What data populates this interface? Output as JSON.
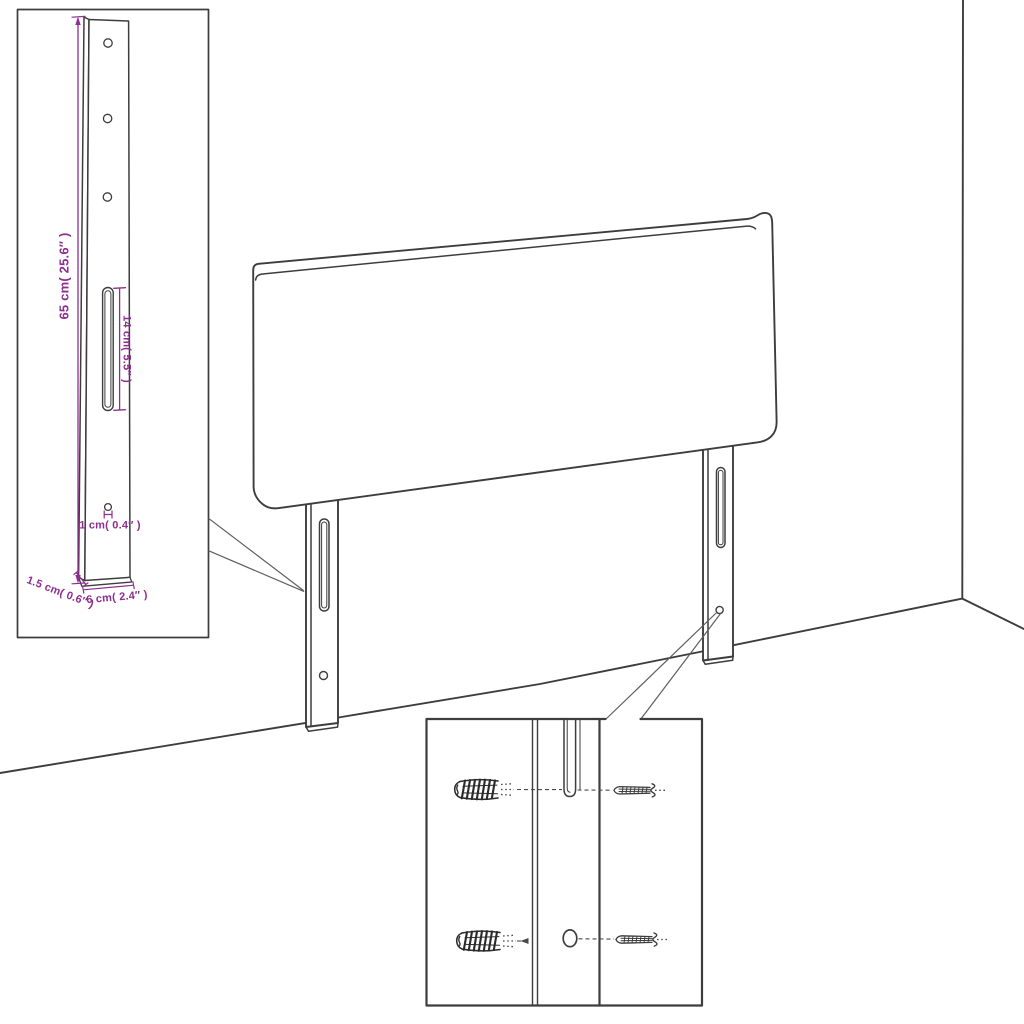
{
  "diagram": {
    "type": "furniture-assembly-dimension-diagram",
    "subject": "upholstered headboard with two slotted mounting legs, wall-corner perspective, bracket dimension inset and screw/wall-plug mounting inset",
    "colors": {
      "dimension": "#8e2e8e",
      "line": "#3d3d3d",
      "background": "#ffffff"
    },
    "dimensions": {
      "bracket_height": "65 cm( 25.6″ )",
      "slot_length": "14 cm( 5.5″ )",
      "hole_diameter": "1 cm( 0.4″ )",
      "side_depth": "1.5 cm( 0.6″ )",
      "bracket_width": "6 cm( 2.4″ )"
    }
  }
}
